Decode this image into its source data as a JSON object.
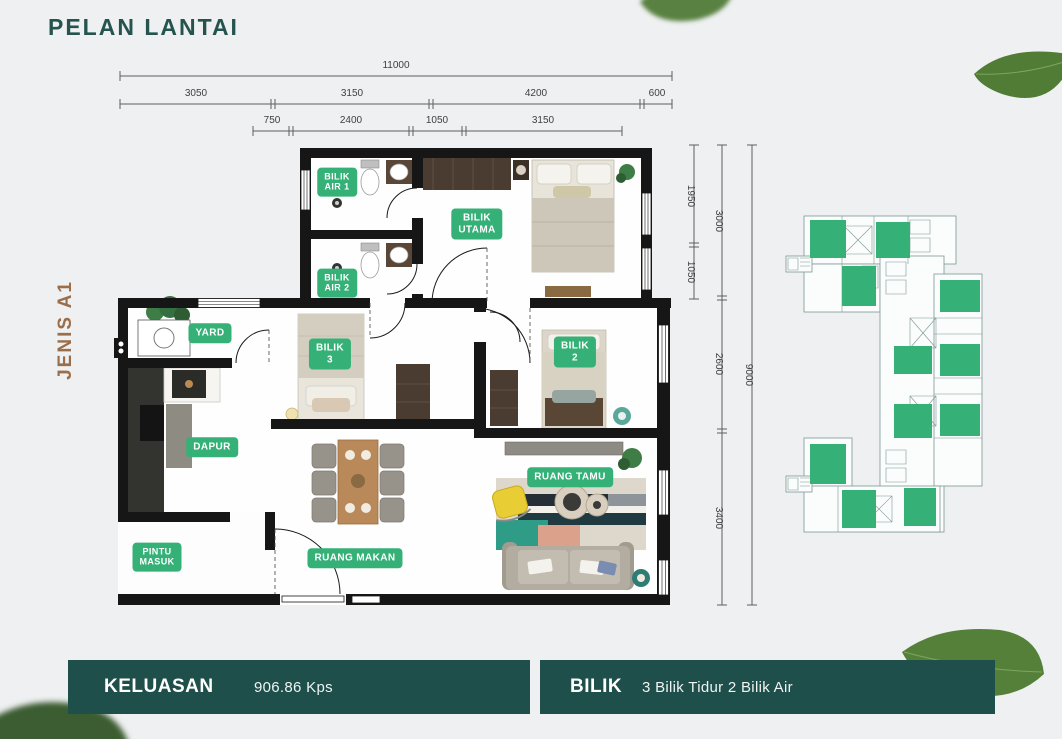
{
  "header": {
    "title": "PELAN LANTAI"
  },
  "unit": {
    "type_label": "JENIS A1"
  },
  "colors": {
    "background": "#EEF0F1",
    "teal_dark": "#1F4F4A",
    "title_teal": "#25544F",
    "label_green": "#35B077",
    "keyplan_green": "#35B077",
    "jenis_brown": "#9B6E4B",
    "wall_black": "#161616",
    "leaf_green": "#547F39"
  },
  "dimensions": {
    "top_total": "11000",
    "top_row2": [
      "3050",
      "3150",
      "4200",
      "600"
    ],
    "top_row3": [
      "750",
      "2400",
      "1050",
      "3150"
    ],
    "right_col1": [
      "1950",
      "1050"
    ],
    "right_col2": [
      "3000",
      "2600",
      "3400"
    ],
    "right_total": "9000"
  },
  "rooms": {
    "bilik_air_1": [
      "BILIK",
      "AIR 1"
    ],
    "bilik_utama": [
      "BILIK",
      "UTAMA"
    ],
    "bilik_air_2": [
      "BILIK",
      "AIR 2"
    ],
    "yard": [
      "YARD"
    ],
    "bilik_3": [
      "BILIK",
      "3"
    ],
    "bilik_2": [
      "BILIK",
      "2"
    ],
    "dapur": [
      "DAPUR"
    ],
    "ruang_tamu": [
      "RUANG TAMU"
    ],
    "pintu_masuk": [
      "PINTU",
      "MASUK"
    ],
    "ruang_makan": [
      "RUANG MAKAN"
    ]
  },
  "footer": {
    "area_label": "KELUASAN",
    "area_value": "906.86 Kps",
    "rooms_label": "BILIK",
    "rooms_value": "3 Bilik Tidur  2 Bilik Air"
  }
}
